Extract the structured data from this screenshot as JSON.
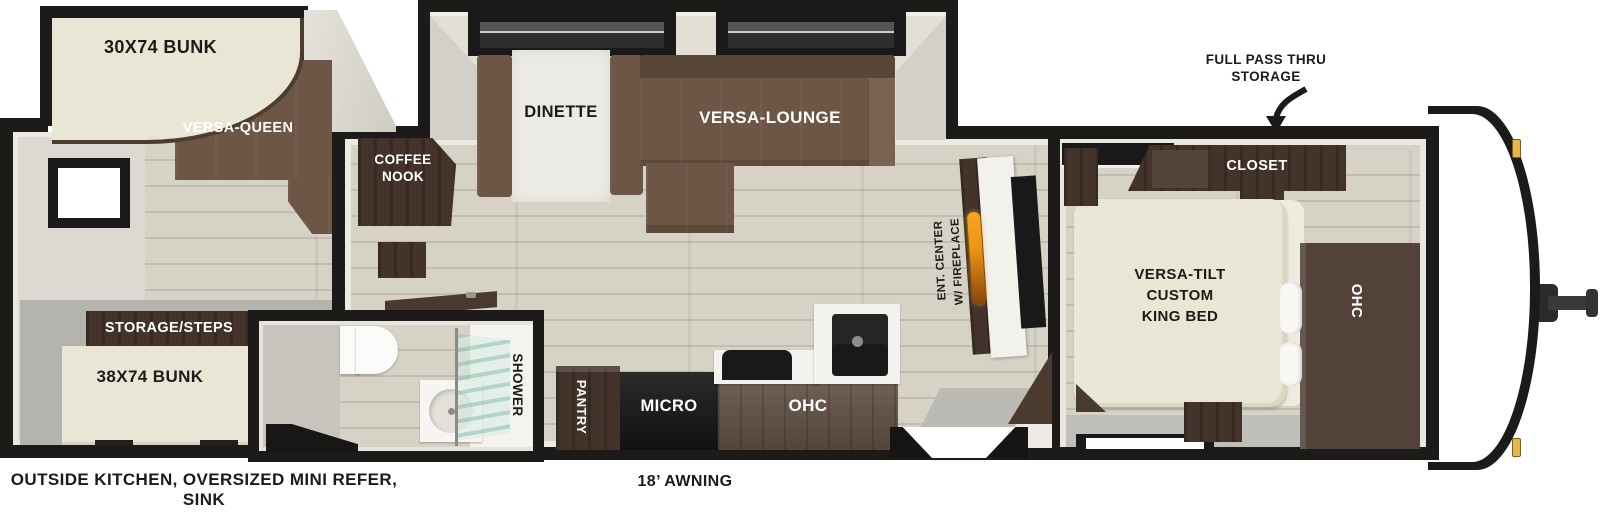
{
  "rear_room": {
    "bunk_label": "30X74 BUNK",
    "sofa_label": "VERSA-QUEEN",
    "storage_label": "STORAGE/STEPS",
    "lower_bunk_label": "38X74 BUNK"
  },
  "bathroom": {
    "shower_label": "SHOWER"
  },
  "main": {
    "coffee_nook_label": "COFFEE NOOK",
    "dinette_label": "DINETTE",
    "lounge_label": "VERSA-LOUNGE",
    "pantry_label": "PANTRY",
    "micro_label": "MICRO",
    "ohc_label": "OHC",
    "ent_center_line1": "ENT. CENTER",
    "ent_center_line2": "W/ FIREPLACE"
  },
  "bedroom": {
    "closet_label": "CLOSET",
    "bed_line1": "VERSA-TILT",
    "bed_line2": "CUSTOM",
    "bed_line3": "KING BED",
    "ohc_label": "OHC"
  },
  "callout": {
    "line1": "FULL PASS THRU",
    "line2": "STORAGE"
  },
  "captions": {
    "outside_line1": "OUTSIDE KITCHEN, OVERSIZED MINI REFER,",
    "outside_line2": "SINK",
    "awning": "18’ AWNING"
  },
  "colors": {
    "wall": "#1d1b1a",
    "wood_floor": "#d6d3c6",
    "sofa_brown": "#6d5645",
    "cabinet_dark": "#43332b",
    "cabinet_mid": "#5d4a3e",
    "bed_cream": "#eae6d5",
    "flame_orange": "#ef9415",
    "marker_light": "#e8b54a"
  }
}
